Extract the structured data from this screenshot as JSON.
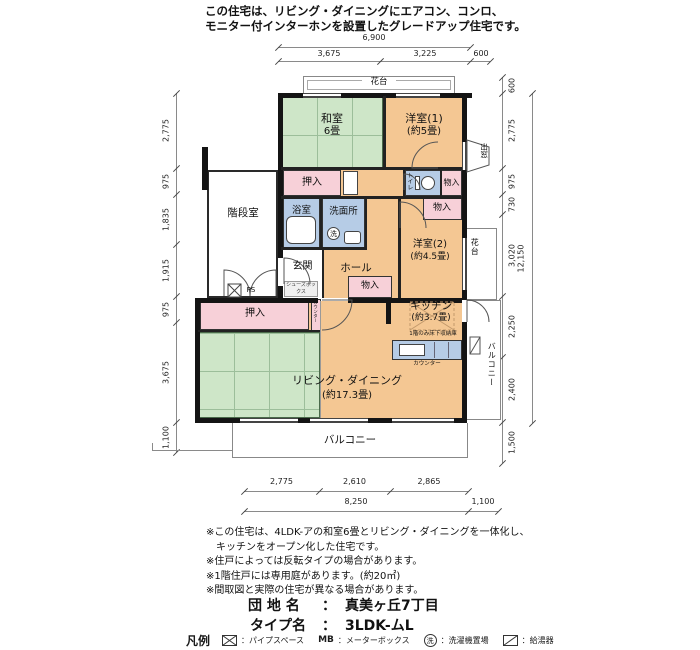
{
  "header": {
    "line1": "この住宅は、リビング・ダイニングにエアコン、コンロ、",
    "line2": "モニター付インターホンを設置したグレードアップ住宅です。"
  },
  "dims": {
    "top_total": "6,900",
    "top_seg1": "3,675",
    "top_seg2": "3,225",
    "top_seg3": "600",
    "bottom_seg1": "2,775",
    "bottom_seg2": "2,610",
    "bottom_seg3": "2,865",
    "bottom_total": "8,250",
    "bottom_right": "1,100",
    "left": [
      "2,775",
      "975",
      "1,835",
      "1,915",
      "975",
      "3,675",
      "1,100"
    ],
    "right": [
      "600",
      "2,775",
      "975",
      "730",
      "3,020",
      "2,250",
      "2,400",
      "1,500"
    ],
    "right_total": "12,150"
  },
  "plan": {
    "washitsu_name": "和室",
    "washitsu_size": "6畳",
    "yoshitsu1_name": "洋室(1)",
    "yoshitsu1_size": "(約5畳)",
    "yoshitsu2_name": "洋室(2)",
    "yoshitsu2_size": "(約4.5畳)",
    "kitchen_name": "キッチン",
    "kitchen_size": "(約3.7畳)",
    "kitchen_floor_note": "1階のみ床下収納庫",
    "kitchen_counter": "カウンター",
    "living_name": "リビング・ダイニング",
    "living_size": "(約17.3畳)",
    "bath": "浴室",
    "washroom": "洗面所",
    "wash_symbol": "洗",
    "toilet": "トイレ",
    "genkan": "玄関",
    "hall": "ホール",
    "stairs": "階段室",
    "ps": "PS",
    "shoe_box": "シューズボックス",
    "oshiire_top": "押入",
    "oshiire_bottom": "押入",
    "mono_a": "物入",
    "mono_b": "物入",
    "mono_c": "物入",
    "kadai_top": "花台",
    "kadai_right": "花台",
    "demado": "出窓",
    "balcony_bottom": "バルコニー",
    "balcony_right": "バルコニー",
    "counter_strip": "カウンター"
  },
  "notes": [
    "※この住宅は、4LDK-アの和室6畳とリビング・ダイニングを一体化し、",
    "　キッチンをオープン化した住宅です。",
    "※住戸によっては反転タイプの場合があります。",
    "※1階住戸には専用庭があります。(約20㎡)",
    "※間取図と実際の住宅が異なる場合があります。"
  ],
  "footer": {
    "danchi_label": "団 地 名",
    "danchi_sep": "：",
    "danchi_value": "真美ヶ丘7丁目",
    "type_label": "タイプ名",
    "type_sep": "：",
    "type_value": "3LDK-ムL"
  },
  "legend": {
    "title": "凡例",
    "pipe_label": "：パイプスペース",
    "mb_symbol": "MB",
    "mb_label": "：メーターボックス",
    "wash_symbol": "洗",
    "wash_label": "：洗濯機置場",
    "heater_label": "：給湯器"
  },
  "colors": {
    "room": "#f4c793",
    "tatami": "#cee6c8",
    "closet": "#f7d0d8",
    "wet": "#b6cce6",
    "wall": "#141414"
  }
}
